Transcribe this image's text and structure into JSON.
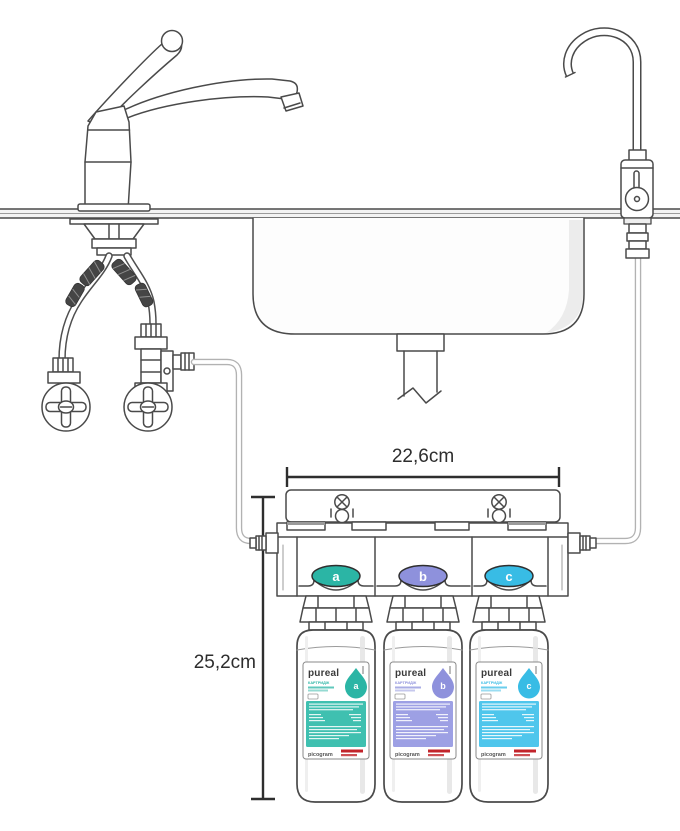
{
  "diagram": {
    "title": "under-sink water filter installation diagram",
    "dimensions": {
      "width": "22,6cm",
      "height": "25,2cm"
    },
    "filter": {
      "brand": "pureal",
      "vendor": "picogram",
      "stages": [
        {
          "letter": "a",
          "badge_color": "#2bb5a5",
          "block_color": "#3fc0b0",
          "cartridge_text": "КАРТРИДЖ"
        },
        {
          "letter": "b",
          "badge_color": "#8e91dc",
          "block_color": "#9da0e4",
          "cartridge_text": "КАРТРИДЖ"
        },
        {
          "letter": "c",
          "badge_color": "#38bce5",
          "block_color": "#4fc6ec",
          "cartridge_text": "КАРТРИДЖ"
        }
      ]
    },
    "colors": {
      "line": "#4a4a4a",
      "tube": "#b2b2b2",
      "dimension": "#2d2d2d",
      "logo_red": "#c2242b"
    }
  }
}
